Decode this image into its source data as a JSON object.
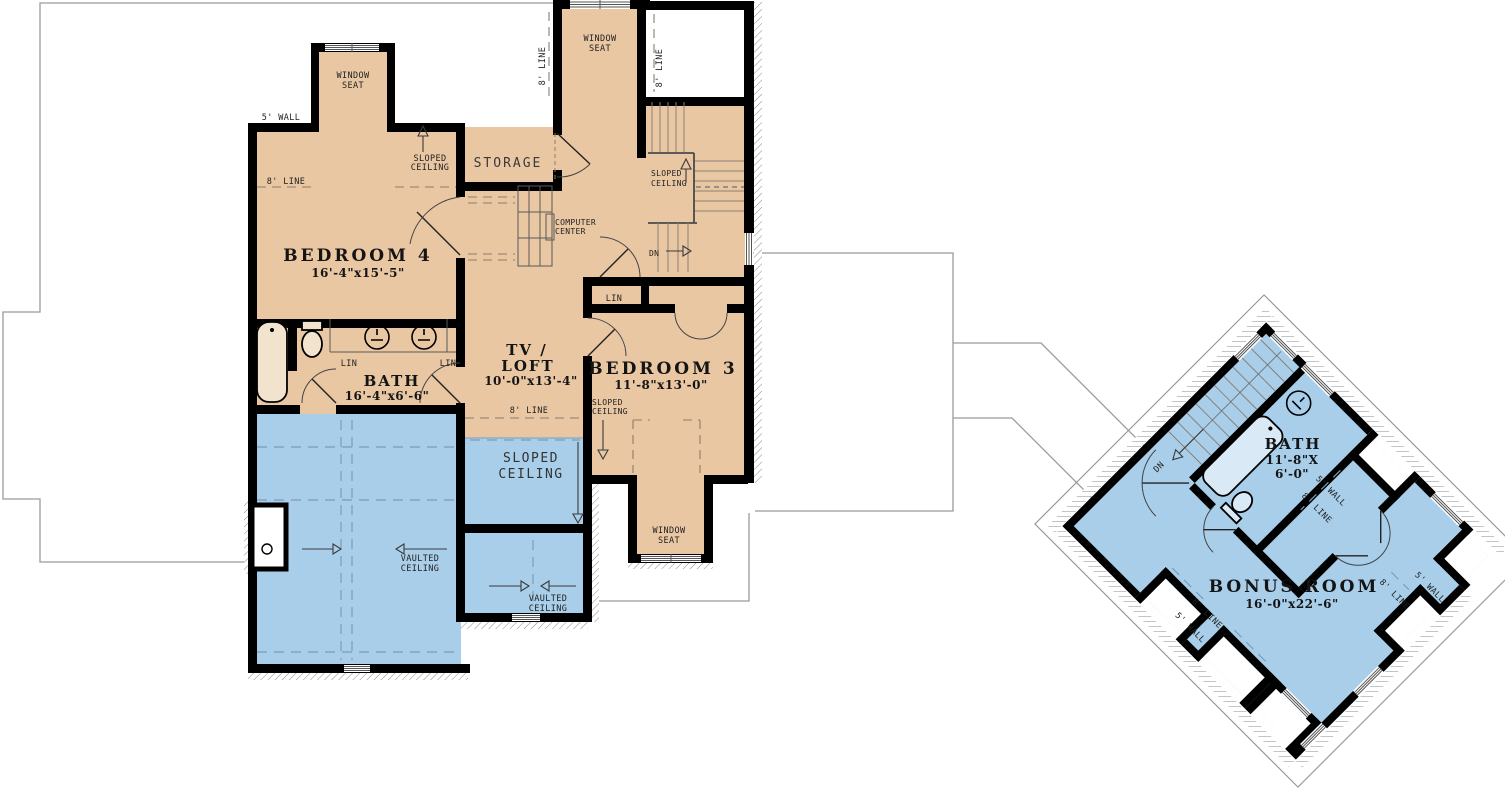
{
  "plan": {
    "colors": {
      "floor_tan": "#e9c7a3",
      "floor_blue": "#a9cee9",
      "wall": "#000000",
      "roofline": "#9a9a9a"
    },
    "rooms": {
      "bedroom4": {
        "name": "BEDROOM 4",
        "dims": "16'-4\"x15'-5\""
      },
      "bath_main": {
        "name": "BATH",
        "dims": "16'-4\"x6'-6\""
      },
      "tv_loft": {
        "name_line1": "TV /",
        "name_line2": "LOFT",
        "dims": "10'-0\"x13'-4\""
      },
      "bedroom3": {
        "name": "BEDROOM 3",
        "dims": "11'-8\"x13'-0\""
      },
      "storage": {
        "name": "STORAGE"
      },
      "bonus_room": {
        "name": "BONUS ROOM",
        "dims": "16'-0\"x22'-6\""
      },
      "bath_bonus": {
        "name": "BATH",
        "dims_line1": "11'-8\"X",
        "dims_line2": "6'-0\""
      }
    },
    "annotations": {
      "window_seat_line1": "WINDOW",
      "window_seat_line2": "SEAT",
      "sloped_line1": "SLOPED",
      "sloped_line2": "CEILING",
      "vaulted_line1": "VAULTED",
      "vaulted_line2": "CEILING",
      "computer_line1": "COMPUTER",
      "computer_line2": "CENTER",
      "lin": "LIN",
      "dn": "DN",
      "wall5": "5' WALL",
      "line8": "8' LINE"
    }
  }
}
